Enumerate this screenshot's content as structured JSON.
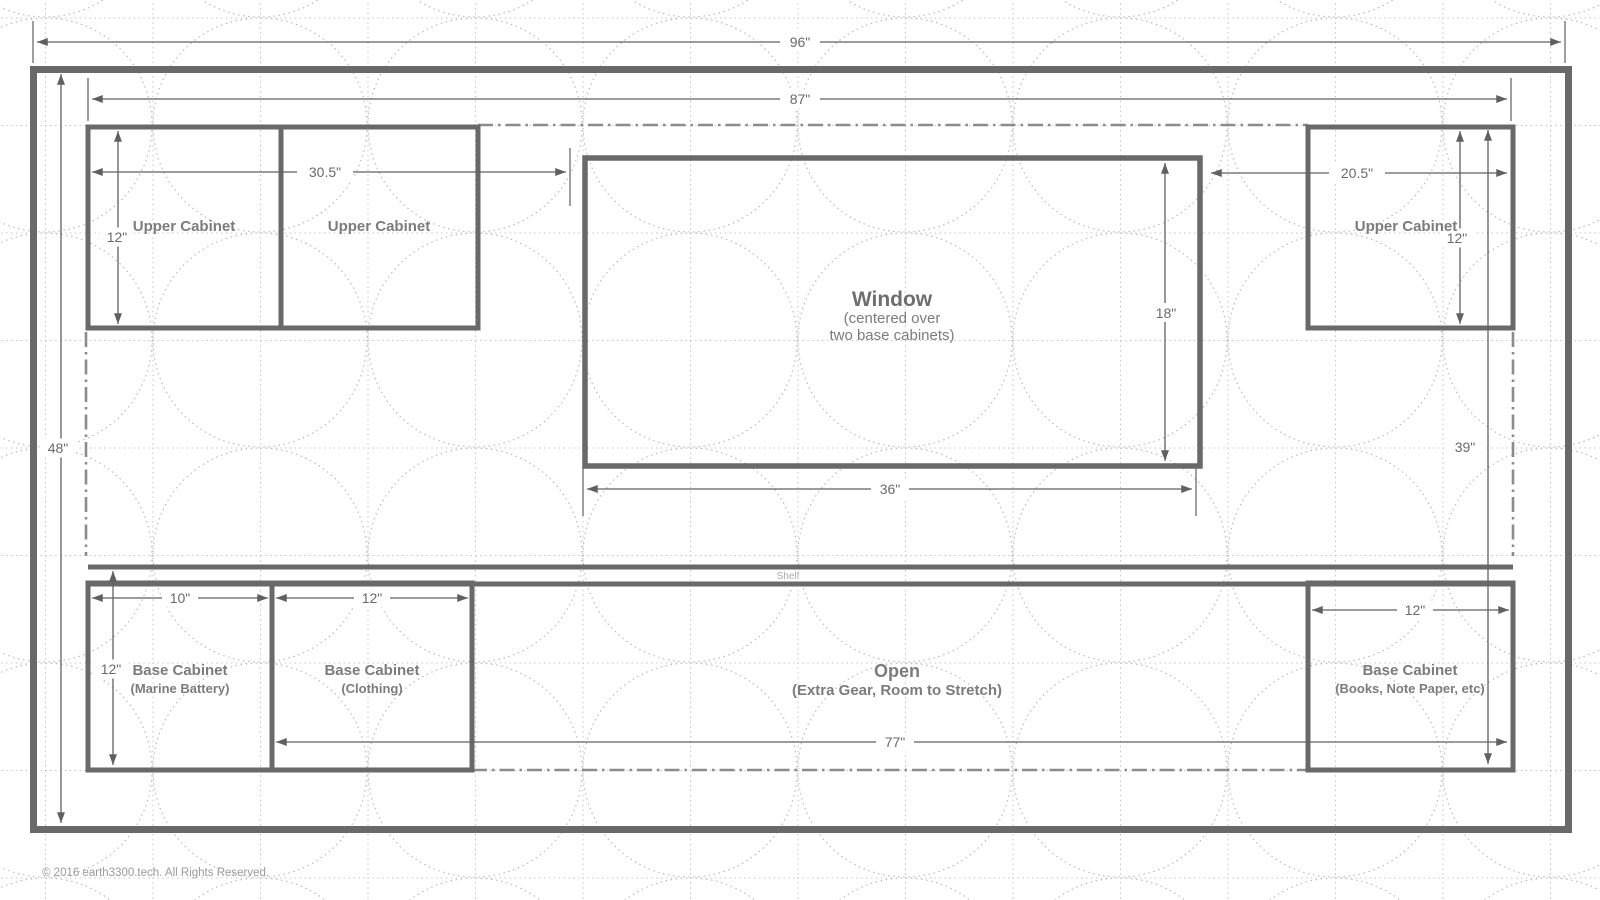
{
  "wall": {
    "dim_overall_width": "96\"",
    "dim_interior_width": "87\"",
    "dim_height_left": "48\"",
    "dim_height_right": "39\""
  },
  "upper": {
    "cabinet1_label": "Upper Cabinet",
    "cabinet2_label": "Upper Cabinet",
    "cabinet3_label": "Upper Cabinet",
    "dim_left_pair_width": "30.5\"",
    "dim_left_height": "12\"",
    "dim_right_width": "20.5\"",
    "dim_right_height": "12\""
  },
  "window": {
    "title": "Window",
    "sub1": "(centered over",
    "sub2": "two base cabinets)",
    "dim_height": "18\"",
    "dim_width": "36\""
  },
  "shelf": {
    "label": "Shelf"
  },
  "base": {
    "cab1_title": "Base Cabinet",
    "cab1_sub": "(Marine Battery)",
    "cab1_dim_width": "10\"",
    "cab1_dim_height": "12\"",
    "cab2_title": "Base Cabinet",
    "cab2_sub": "(Clothing)",
    "cab2_dim_width": "12\"",
    "open_title": "Open",
    "open_sub": "(Extra Gear, Room to Stretch)",
    "open_dim_width": "77\"",
    "cab3_title": "Base Cabinet",
    "cab3_sub": "(Books, Note Paper, etc)",
    "cab3_dim_width": "12\""
  },
  "footer": {
    "copyright": "© 2016 earth3300.tech. All Rights Reserved."
  },
  "colors": {
    "bg": "#ffffff",
    "line": "#696969",
    "dim": "#606060",
    "dimtext": "#6a6a6a",
    "text": "#7c7c7c",
    "dashdot": "#8c8c8c",
    "pattern_grid": "#c4c4c4",
    "pattern_circle": "#b9b9b9"
  }
}
